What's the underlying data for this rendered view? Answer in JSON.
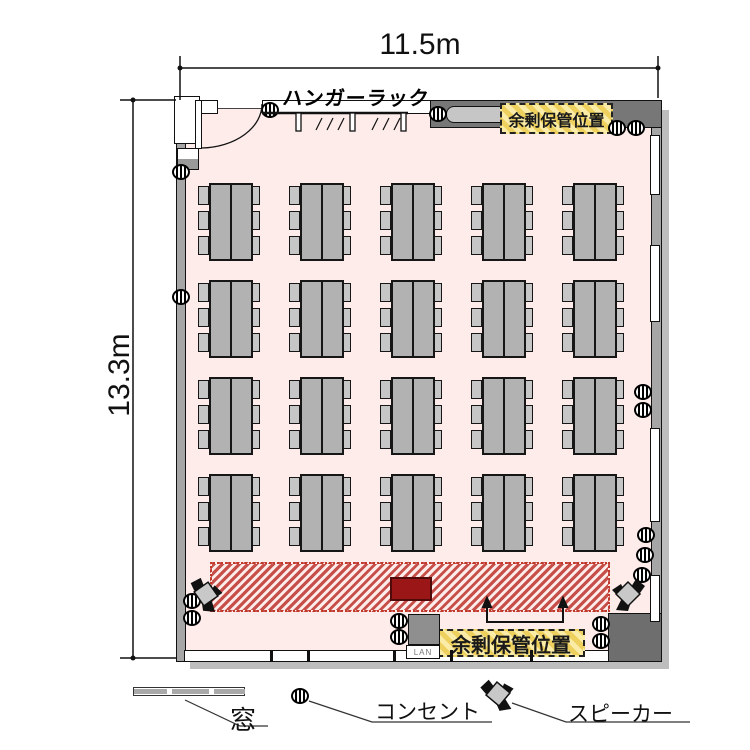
{
  "dimensions": {
    "width_label": "11.5m",
    "height_label": "13.3m"
  },
  "room": {
    "hanger_rack_label": "ハンガーラック",
    "storage_label_top": "余剰保管位置",
    "storage_label_bottom": "余剰保管位置",
    "lan_label": "LAN"
  },
  "legend": {
    "window_label": "窓",
    "outlet_label": "コンセント",
    "speaker_label": "スピーカー"
  },
  "colors": {
    "floor": "#fdecea",
    "wall": "#a6a6a6",
    "wall_dark": "#6e6e6e",
    "table": "#b2b2b2",
    "chair": "#c6c6c6",
    "stage_hatch": "#bc342e",
    "stage_solid": "#9b1717",
    "storage_fill": "#faeca6",
    "storage_hatch": "#eed05e"
  },
  "floorplan": {
    "tables": {
      "rows": 4,
      "cols": 5,
      "row_tops": [
        183,
        280,
        377,
        474
      ],
      "col_lefts": [
        198,
        289,
        380,
        471,
        562
      ],
      "chairs_per_side": 3,
      "seats_per_table": 6
    },
    "outlets": [
      [
        270,
        110
      ],
      [
        438,
        114
      ],
      [
        617,
        128
      ],
      [
        636,
        128
      ],
      [
        181,
        172
      ],
      [
        181,
        297
      ],
      [
        643,
        392
      ],
      [
        643,
        410
      ],
      [
        646,
        535
      ],
      [
        645,
        555
      ],
      [
        642,
        575
      ],
      [
        192,
        601
      ],
      [
        192,
        618
      ],
      [
        399,
        621
      ],
      [
        399,
        637
      ],
      [
        601,
        624
      ],
      [
        601,
        641
      ]
    ],
    "speakers": [
      {
        "x": 206,
        "y": 594,
        "angle": 10,
        "flip": false
      },
      {
        "x": 628,
        "y": 594,
        "angle": 0,
        "flip": true
      },
      {
        "x": 498,
        "y": 694,
        "angle": -5,
        "flip": false
      }
    ],
    "right_windows": [
      [
        135,
        60
      ],
      [
        245,
        77
      ],
      [
        428,
        94
      ],
      [
        575,
        47
      ]
    ],
    "bottom_ticks": [
      270,
      307,
      393,
      450,
      530
    ]
  }
}
